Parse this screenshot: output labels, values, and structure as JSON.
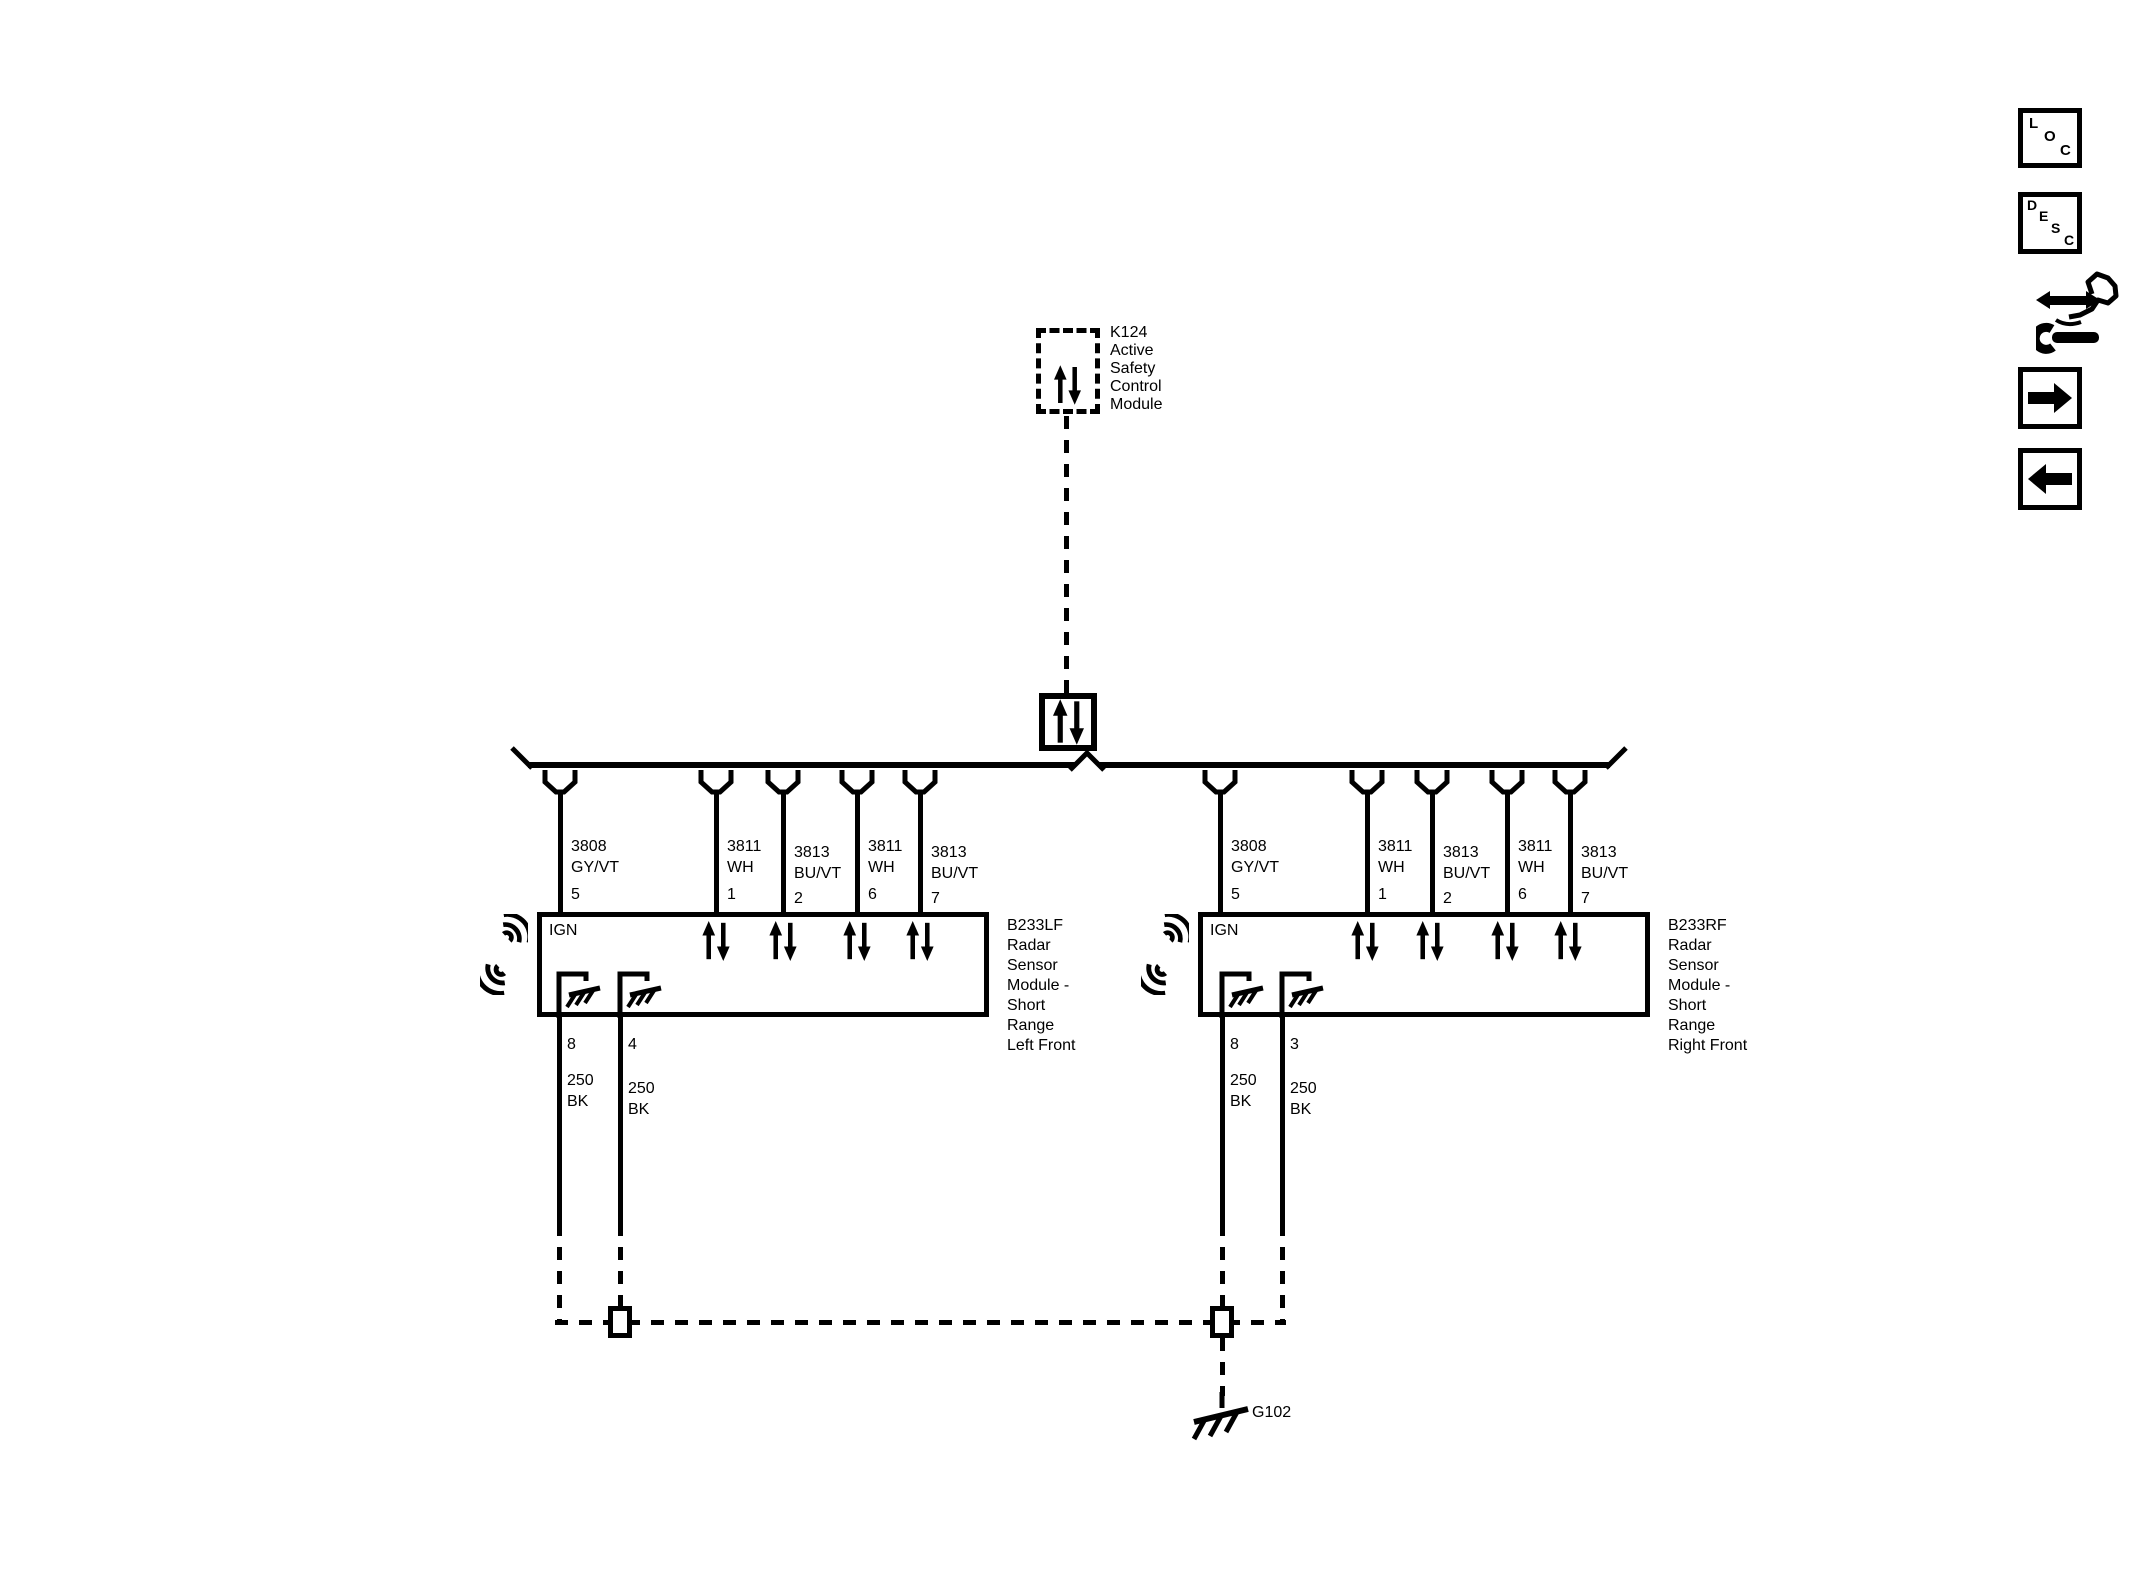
{
  "diagram": {
    "background": "#ffffff",
    "wire_color": "#000000",
    "control_module": {
      "label": "K124\nActive\nSafety\nControl\nModule"
    },
    "left_module": {
      "label": "B233LF\nRadar\nSensor\nModule -\nShort\nRange\nLeft Front",
      "ign": "IGN",
      "top_pins": [
        {
          "pin": "5",
          "wire": "3808\nGY/VT"
        },
        {
          "pin": "1",
          "wire": "3811\nWH"
        },
        {
          "pin": "2",
          "wire": "3813\nBU/VT"
        },
        {
          "pin": "6",
          "wire": "3811\nWH"
        },
        {
          "pin": "7",
          "wire": "3813\nBU/VT"
        }
      ],
      "bottom_pins": [
        {
          "pin": "8",
          "wire": "250\nBK"
        },
        {
          "pin": "4",
          "wire": "250\nBK"
        }
      ]
    },
    "right_module": {
      "label": "B233RF\nRadar\nSensor\nModule -\nShort\nRange\nRight Front",
      "ign": "IGN",
      "top_pins": [
        {
          "pin": "5",
          "wire": "3808\nGY/VT"
        },
        {
          "pin": "1",
          "wire": "3811\nWH"
        },
        {
          "pin": "2",
          "wire": "3813\nBU/VT"
        },
        {
          "pin": "6",
          "wire": "3811\nWH"
        },
        {
          "pin": "7",
          "wire": "3813\nBU/VT"
        }
      ],
      "bottom_pins": [
        {
          "pin": "8",
          "wire": "250\nBK"
        },
        {
          "pin": "3",
          "wire": "250\nBK"
        }
      ]
    },
    "ground": {
      "label": "G102"
    }
  },
  "sidebar": {
    "loc_letters": [
      "L",
      "O",
      "C"
    ],
    "desc_letters": [
      "D",
      "E",
      "S",
      "C"
    ]
  }
}
